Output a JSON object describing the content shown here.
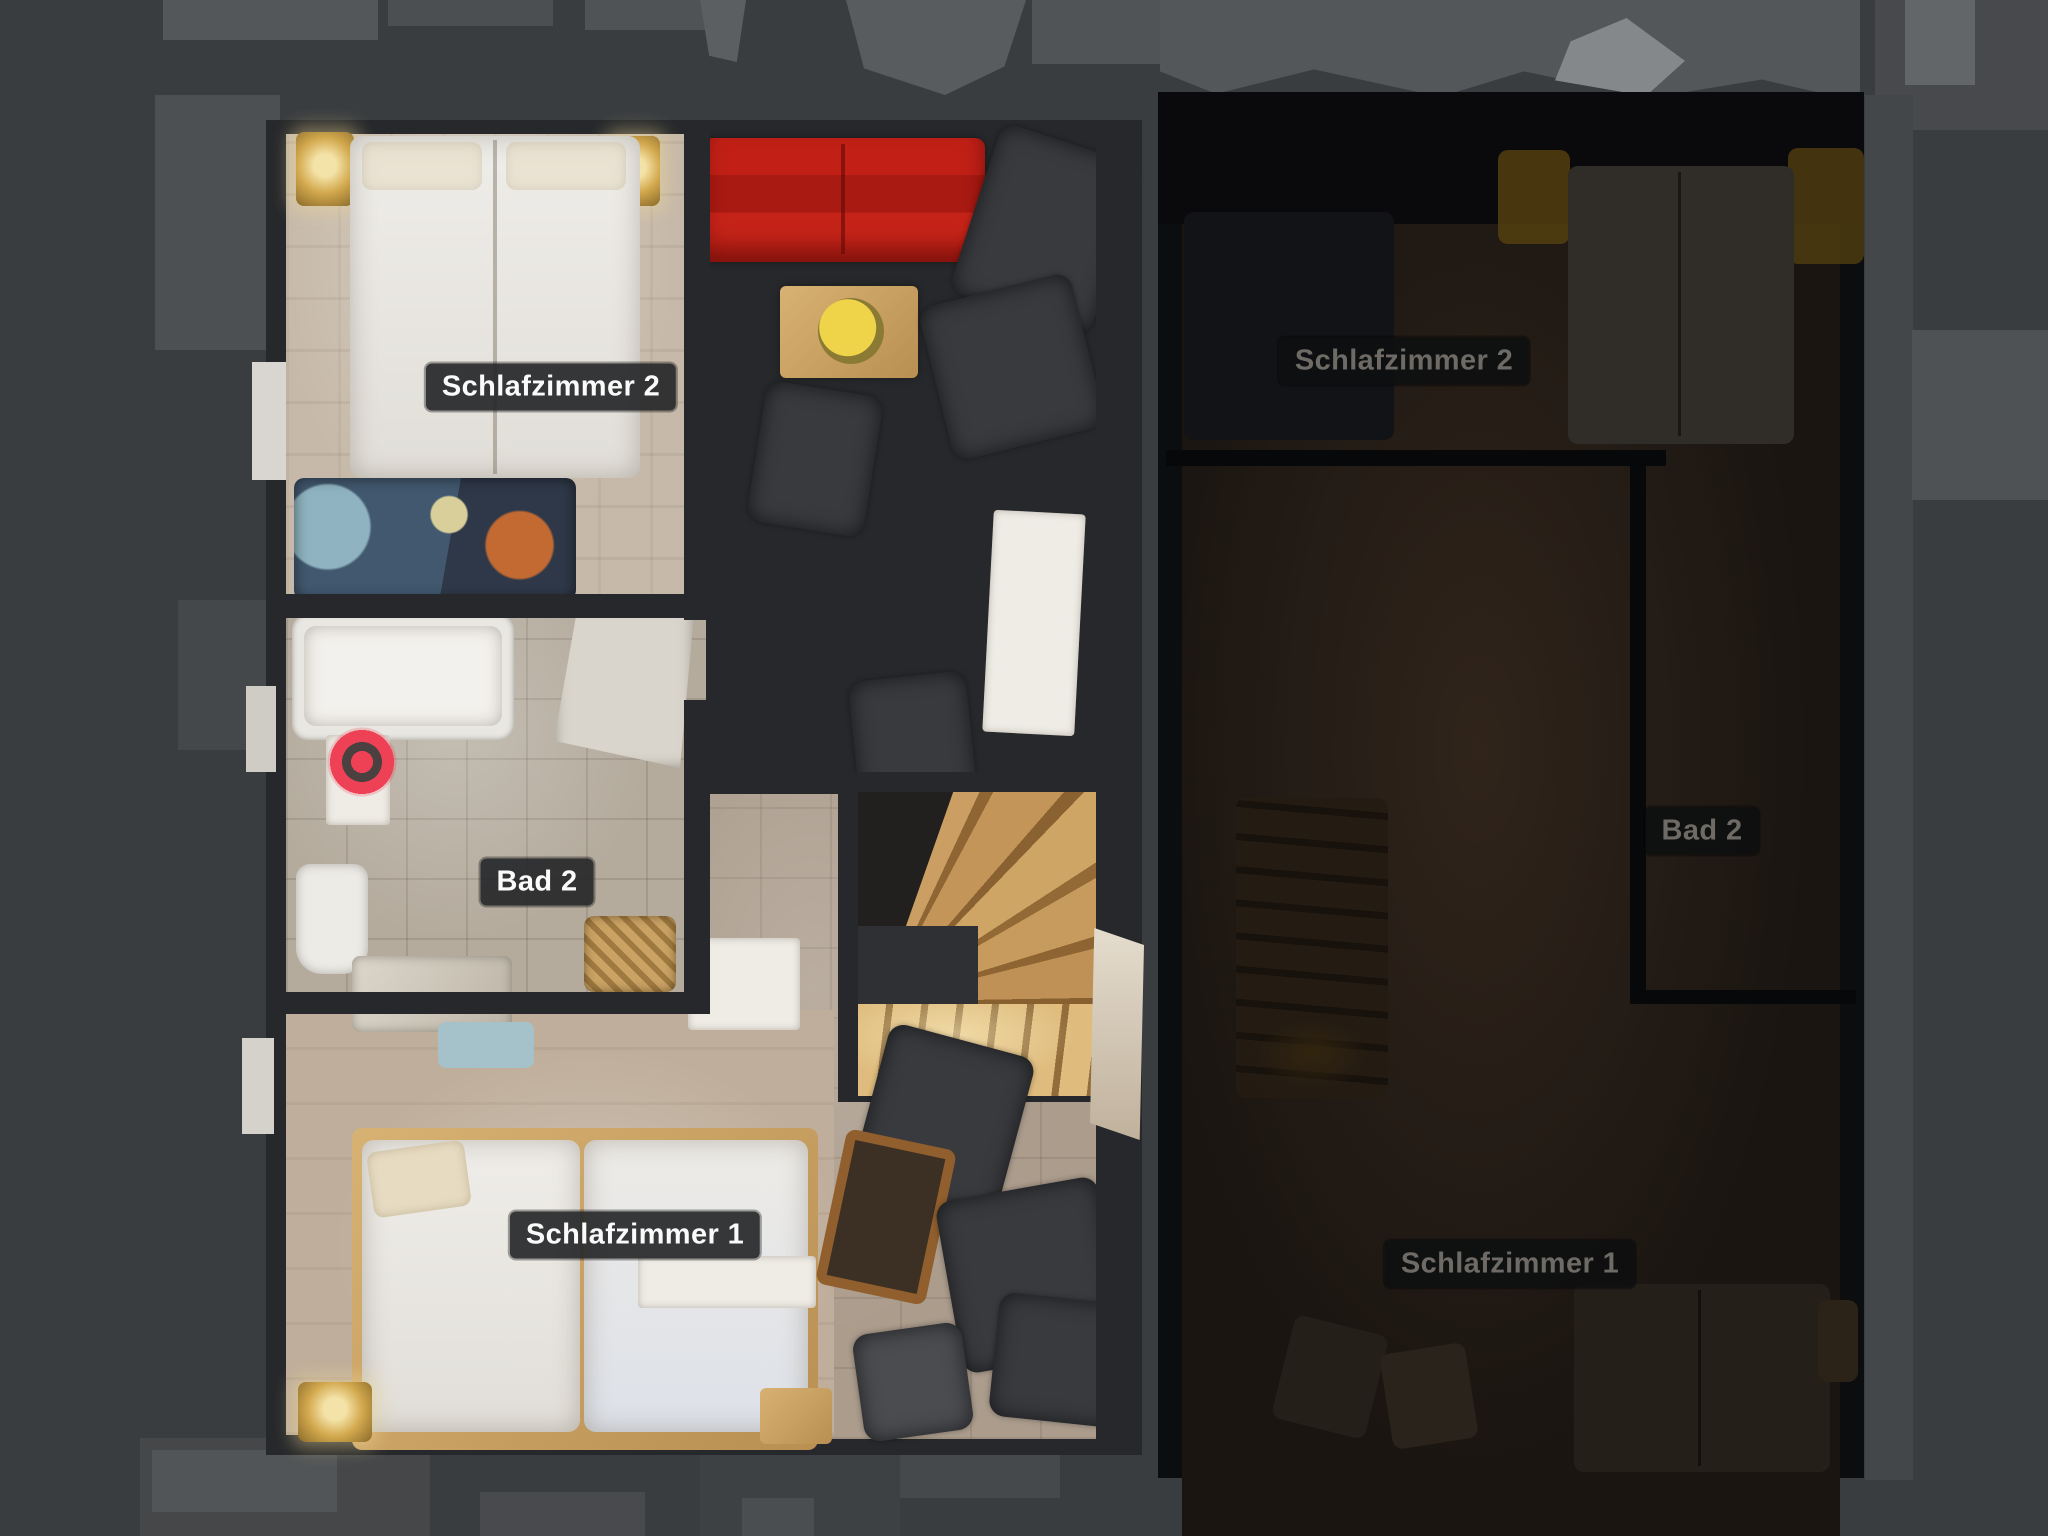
{
  "viewer": {
    "view_mode": "floorplan",
    "background_color": "#3a3d40"
  },
  "floors": {
    "active": {
      "state": "active",
      "rooms": [
        {
          "label": "Schlafzimmer 2"
        },
        {
          "label": "Bad 2"
        },
        {
          "label": "Schlafzimmer 1"
        }
      ]
    },
    "inactive": {
      "state": "inactive",
      "rooms": [
        {
          "label": "Schlafzimmer 2"
        },
        {
          "label": "Bad 2"
        },
        {
          "label": "Schlafzimmer 1"
        }
      ]
    }
  },
  "marker": {
    "type": "current-position",
    "color": "#ef4156"
  },
  "colors": {
    "background": "#3a3d40",
    "label_bg": "#29292b",
    "label_text": "#fafafa",
    "dim_label_text": "#6e6a65",
    "sofa_red": "#b8 1d15",
    "stair_wood": "#c49a5d"
  }
}
